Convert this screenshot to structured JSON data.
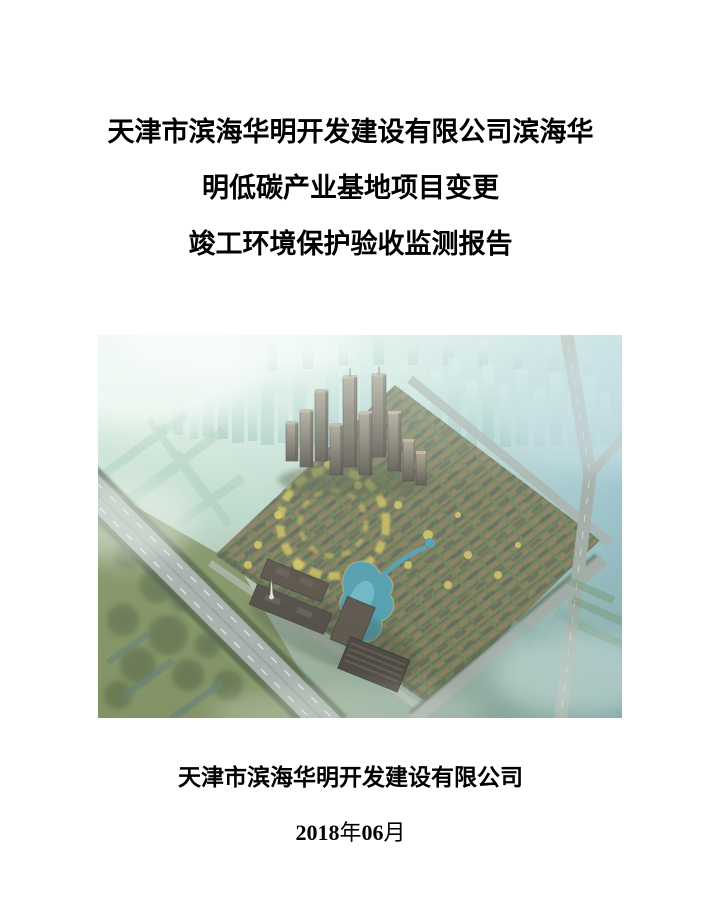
{
  "document": {
    "title_lines": [
      "天津市滨海华明开发建设有限公司滨海华",
      "明低碳产业基地项目变更",
      "竣工环境保护验收监测报告"
    ],
    "publisher": "天津市滨海华明开发建设有限公司",
    "date": {
      "year": "2018",
      "year_unit": "年",
      "month": "06",
      "month_unit": "月"
    },
    "cover_image": {
      "icon": "aerial-rendering-of-residential-development",
      "colors": {
        "haze_teal": "#abd4cd",
        "ghost_building": "#9ccfc6",
        "field_green": "#7b8d5c",
        "roof_warm": "#8a7054",
        "roof_dark": "#454e4e",
        "tree_yellow": "#d2c258",
        "pond_blue": "#4697aa",
        "road_gray": "#9aa3a0",
        "tower_brown": "#6d6355",
        "building_dark": "#453e37"
      }
    }
  }
}
